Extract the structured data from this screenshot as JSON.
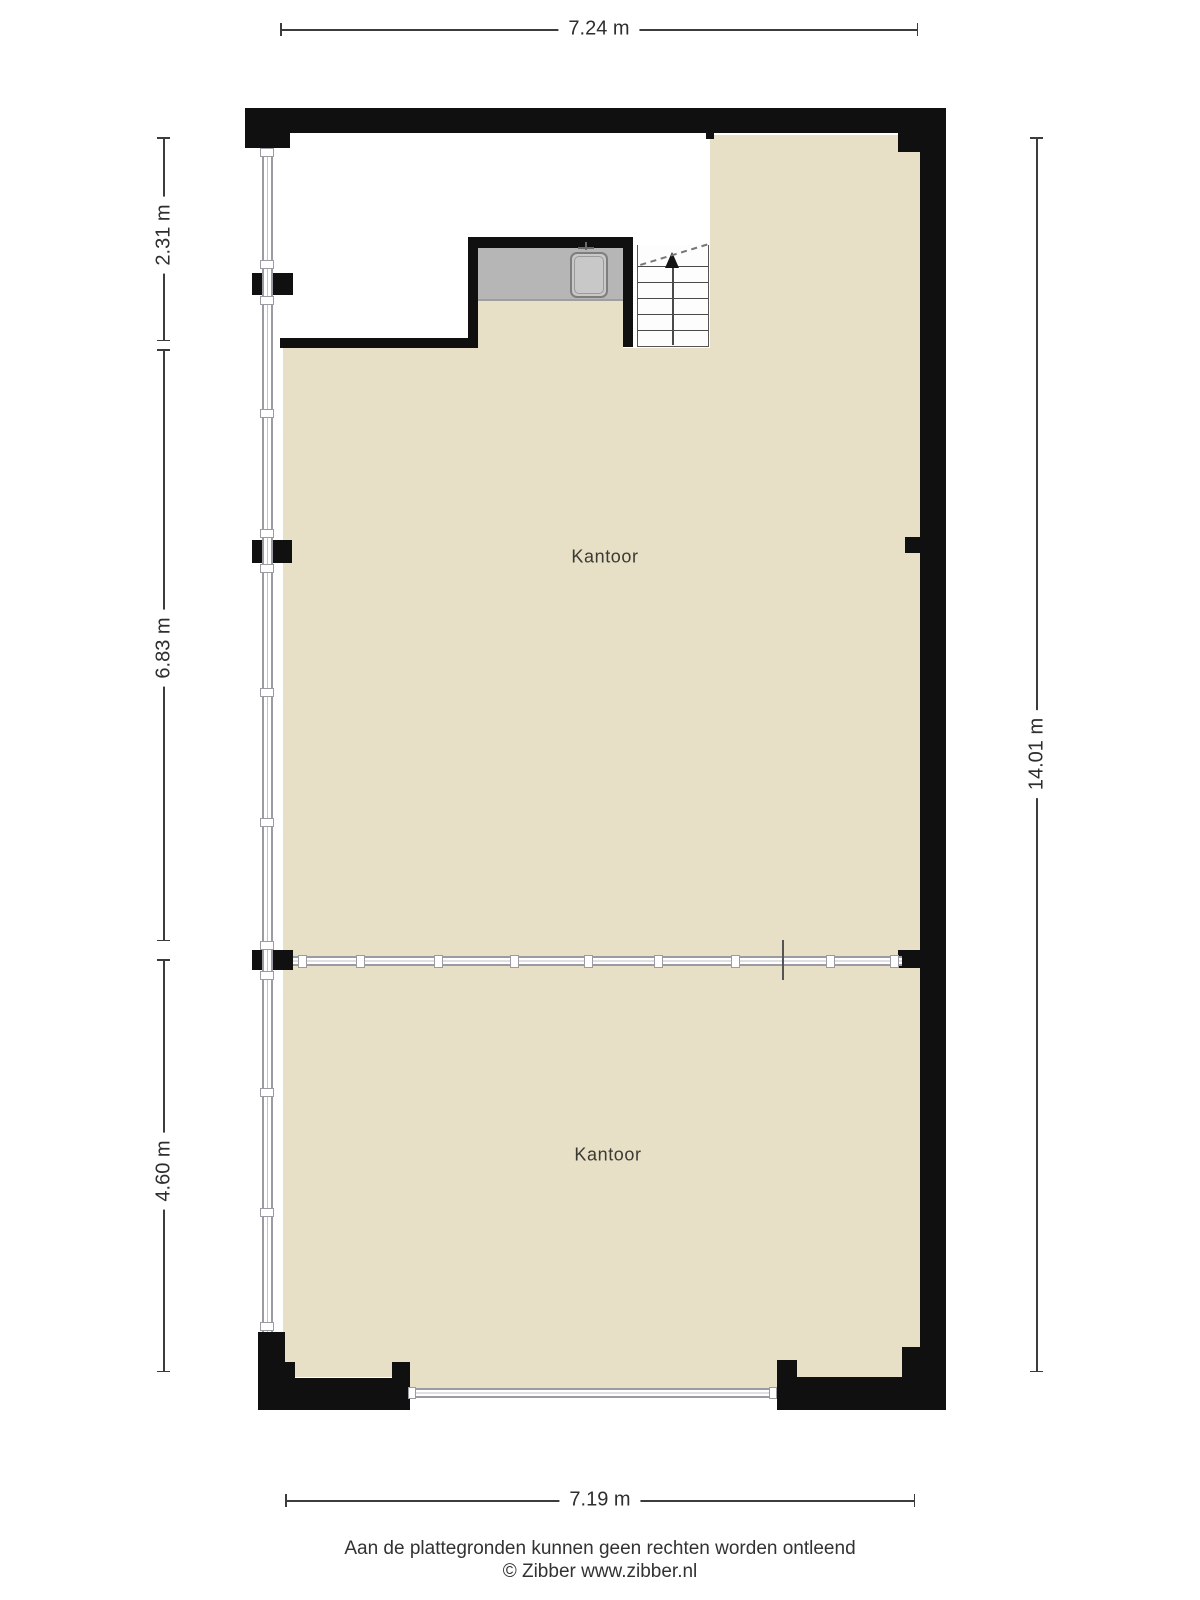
{
  "plan": {
    "rooms": [
      {
        "label": "Kantoor"
      },
      {
        "label": "Kantoor"
      }
    ],
    "dimensions": {
      "top": "7.24 m",
      "left_top": "2.31 m",
      "left_middle": "6.83 m",
      "left_bottom": "4.60 m",
      "right": "14.01 m",
      "bottom": "7.19 m"
    },
    "footer": {
      "disclaimer": "Aan de plattegronden kunnen geen rechten worden ontleend",
      "copyright": "© Zibber www.zibber.nl"
    },
    "colors": {
      "floor": "#E7DFC6",
      "wall": "#101010",
      "window_frame": "#9B9BA3",
      "counter": "#B6B6B6",
      "sink": "#C8C8C8",
      "dimension": "#3C3C3C"
    }
  }
}
